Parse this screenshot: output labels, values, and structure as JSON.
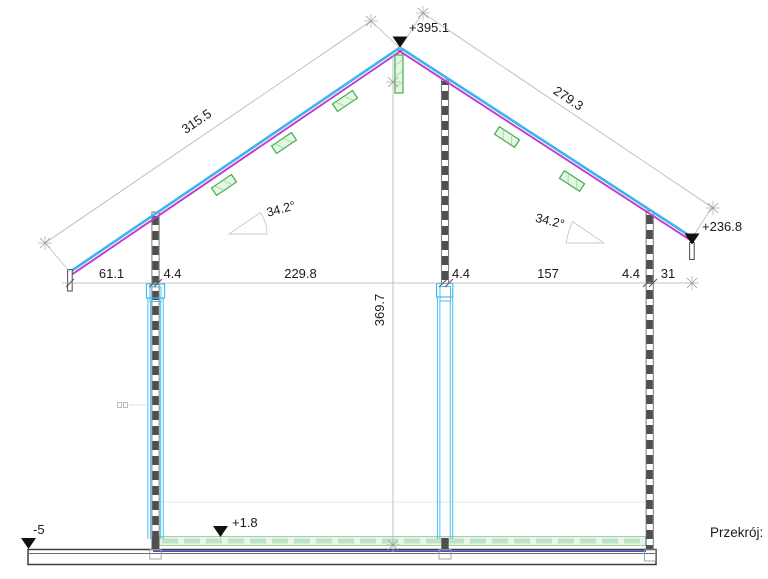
{
  "drawing": {
    "caption": "Przekrój:",
    "levels": {
      "ridge": "+395.1",
      "eave_right": "+236.8",
      "floor": "+1.8",
      "terrain": "-5"
    },
    "roof": {
      "left_length": "315.5",
      "right_length": "279.3",
      "left_angle": "34.2°",
      "right_angle": "34.2°"
    },
    "dims": {
      "h": [
        "61.1",
        "4.4",
        "229.8",
        "4.4",
        "157",
        "4.4",
        "31"
      ],
      "interior_height": "369.7"
    },
    "colors": {
      "roof_top": "#3db4ee",
      "roof_underlay": "#c438cc",
      "timber_blocks": "#3fae4a",
      "frame_outline": "#41bdf1",
      "floor_layer_line": "#4753c4",
      "floor_fill": "#e9f5ea",
      "wall_fill": "#4f4f4f",
      "dimension_line": "#b3b3b3",
      "text": "#1a1a1a"
    }
  }
}
